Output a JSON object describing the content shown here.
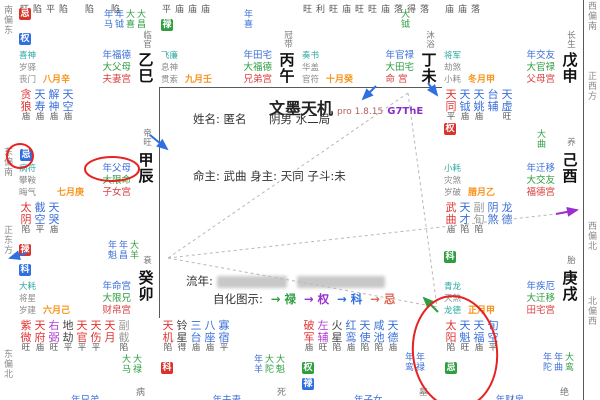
{
  "app": {
    "title": "文墨天机",
    "version": "pro 1.8.15",
    "build": "G7ThE"
  },
  "profile": {
    "name_label": "姓名:",
    "name": "匿名",
    "yinyang": "阴男",
    "bureau": "水二局",
    "ming_label": "命主:",
    "ming": "武曲",
    "shen_label": "身主:",
    "shen": "天同",
    "zidou_label": "子斗:",
    "zidou": "未",
    "liunian_label": "流年:",
    "zihua_label": "自化图示:",
    "zihua": [
      {
        "t": "→ 禄",
        "c": "#2f9e41"
      },
      {
        "t": "→ 权",
        "c": "#9b30d0"
      },
      {
        "t": "→ 科",
        "c": "#2f6fe0"
      },
      {
        "t": "→ 忌",
        "c": "#e2654f"
      }
    ]
  },
  "compass": {
    "left": [
      "南偏东",
      "东偏南",
      "正东方",
      "东偏北"
    ],
    "right": [
      "西偏南",
      "正西方",
      "西偏北",
      "北偏西"
    ]
  },
  "colors": {
    "main_star": "#e03434",
    "aux_star": "#3a6fd8",
    "purple_star": "#b040d0",
    "dark_star": "#444444",
    "gray_star": "#999999",
    "year_label": "#3a6fd8",
    "decade_label": "#2f9e41",
    "palace_label": "#d94040",
    "month": "#f7941d",
    "highlight": "#e62222"
  },
  "palaces": [
    {
      "id": "si",
      "branch": "乙巳",
      "stage": "临官",
      "month": "八月辛",
      "ratings_top": "旺陷平陷　陷　陷",
      "stars": [],
      "badges": [
        {
          "t": "忌",
          "bg": "#d9342b"
        },
        {
          "t": "权",
          "bg": "#2f6fe0"
        }
      ],
      "flow": [
        {
          "t": "年马",
          "c": "#3a6fd8"
        },
        {
          "t": "年钺",
          "c": "#3a6fd8"
        },
        {
          "t": "大喜",
          "c": "#2f9e41"
        },
        {
          "t": "大昌",
          "c": "#2f9e41"
        }
      ],
      "smalls": [
        {
          "t": "喜神",
          "c": "#2aa8a0"
        },
        {
          "t": "岁驿",
          "c": "#8a8a8a"
        },
        {
          "t": "丧门",
          "c": "#8a8a8a"
        }
      ],
      "labels": [
        {
          "t": "年福德",
          "c": "#3a6fd8"
        },
        {
          "t": "大父母",
          "c": "#2f9e41"
        },
        {
          "t": "夫妻宫",
          "c": "#d94040"
        }
      ]
    },
    {
      "id": "wu",
      "branch": "丙午",
      "stage": "冠带",
      "month": "九月壬",
      "ratings_top": "平庙庙庙",
      "stars": [],
      "badges": [
        {
          "t": "禄",
          "bg": "#2f9e41"
        }
      ],
      "flow": [
        {
          "t": "年喜",
          "c": "#3a6fd8"
        }
      ],
      "smalls": [
        {
          "t": "飞廉",
          "c": "#2aa8a0"
        },
        {
          "t": "息神",
          "c": "#8a8a8a"
        },
        {
          "t": "贯索",
          "c": "#8a8a8a"
        }
      ],
      "labels": [
        {
          "t": "年田宅",
          "c": "#3a6fd8"
        },
        {
          "t": "大福德",
          "c": "#2f9e41"
        },
        {
          "t": "兄弟宫",
          "c": "#d94040"
        }
      ]
    },
    {
      "id": "wei",
      "branch": "丁未",
      "stage": "沐浴",
      "month": "十月癸",
      "ratings_top": "旺利旺庙旺旺庙落得落",
      "stars": [],
      "badges": [],
      "flow": [
        {
          "t": "大钺",
          "c": "#2f9e41"
        }
      ],
      "smalls": [
        {
          "t": "奏书",
          "c": "#2aa8a0"
        },
        {
          "t": "华盖",
          "c": "#8a8a8a"
        },
        {
          "t": "官符",
          "c": "#8a8a8a"
        }
      ],
      "labels": [
        {
          "t": "年官禄",
          "c": "#3a6fd8"
        },
        {
          "t": "大田宅",
          "c": "#2f9e41"
        },
        {
          "t": "命 宫",
          "c": "#d94040"
        }
      ]
    },
    {
      "id": "shen",
      "branch": "戊申",
      "stage": "长生",
      "month": "冬月甲",
      "ratings_top": "庙庙落",
      "stars": [],
      "badges": [],
      "flow": [],
      "smalls": [
        {
          "t": "将军",
          "c": "#2aa8a0"
        },
        {
          "t": "劫煞",
          "c": "#8a8a8a"
        },
        {
          "t": "小耗",
          "c": "#8a8a8a"
        }
      ],
      "labels": [
        {
          "t": "年交友",
          "c": "#3a6fd8"
        },
        {
          "t": "大官禄",
          "c": "#2f9e41"
        },
        {
          "t": "父母宫",
          "c": "#d94040"
        }
      ]
    },
    {
      "id": "chen",
      "branch": "甲辰",
      "stage": "帝旺",
      "month": "七月庚",
      "ratings_top": "",
      "stars": [
        {
          "n": "贪狼",
          "c": "#e03434",
          "r": "庙"
        },
        {
          "n": "天寿",
          "c": "#3a6fd8",
          "r": "庙"
        },
        {
          "n": "解神",
          "c": "#3a6fd8",
          "r": "庙"
        },
        {
          "n": "天空",
          "c": "#3a6fd8",
          "r": "庙"
        }
      ],
      "badges": [
        {
          "t": "忌",
          "bg": "#2f6fe0"
        }
      ],
      "flow": [],
      "smalls": [
        {
          "t": "病符",
          "c": "#2aa8a0"
        },
        {
          "t": "攀鞍",
          "c": "#8a8a8a"
        },
        {
          "t": "晦气",
          "c": "#8a8a8a"
        }
      ],
      "labels": [
        {
          "t": "年父母",
          "c": "#3a6fd8"
        },
        {
          "t": "大限命",
          "c": "#2f9e41"
        },
        {
          "t": "子女宫",
          "c": "#d94040"
        }
      ]
    },
    {
      "id": "you",
      "branch": "己酉",
      "stage": "养",
      "month": "腊月乙",
      "ratings_top": "",
      "stars": [
        {
          "n": "天同",
          "c": "#e03434",
          "r": "平"
        },
        {
          "n": "天钺",
          "c": "#3a6fd8",
          "r": "庙"
        },
        {
          "n": "天姚",
          "c": "#3a6fd8",
          "r": "庙"
        },
        {
          "n": "台辅",
          "c": "#3a6fd8",
          "r": ""
        },
        {
          "n": "天虚",
          "c": "#3a6fd8",
          "r": "旺"
        }
      ],
      "badges": [
        {
          "t": "权",
          "bg": "#d9342b"
        }
      ],
      "flow": [
        {
          "t": "大曲",
          "c": "#2f9e41"
        }
      ],
      "smalls": [
        {
          "t": "小耗",
          "c": "#2aa8a0"
        },
        {
          "t": "灾煞",
          "c": "#8a8a8a"
        },
        {
          "t": "岁破",
          "c": "#8a8a8a"
        }
      ],
      "labels": [
        {
          "t": "年迁移",
          "c": "#3a6fd8"
        },
        {
          "t": "大交友",
          "c": "#2f9e41"
        },
        {
          "t": "福德宫",
          "c": "#d94040"
        }
      ]
    },
    {
      "id": "mao",
      "branch": "癸卯",
      "stage": "衰",
      "month": "六月己",
      "ratings_top": "",
      "stars": [
        {
          "n": "太阴",
          "c": "#e03434",
          "r": "陷"
        },
        {
          "n": "截空",
          "c": "#3a6fd8",
          "r": "平"
        },
        {
          "n": "天哭",
          "c": "#3a6fd8",
          "r": "庙"
        }
      ],
      "badges": [
        {
          "t": "禄",
          "bg": "#d9342b"
        },
        {
          "t": "科",
          "bg": "#2f6fe0"
        }
      ],
      "flow": [
        {
          "t": "年魁",
          "c": "#3a6fd8"
        },
        {
          "t": "年昌",
          "c": "#3a6fd8"
        },
        {
          "t": "大羊",
          "c": "#2f9e41"
        }
      ],
      "smalls": [
        {
          "t": "大耗",
          "c": "#2aa8a0"
        },
        {
          "t": "将星",
          "c": "#8a8a8a"
        },
        {
          "t": "岁建",
          "c": "#8a8a8a"
        }
      ],
      "labels": [
        {
          "t": "年命宫",
          "c": "#3a6fd8"
        },
        {
          "t": "大限兄",
          "c": "#2f9e41"
        },
        {
          "t": "财帛宫",
          "c": "#d94040"
        }
      ]
    },
    {
      "id": "xu",
      "branch": "庚戌",
      "stage": "胎",
      "month": "正月甲",
      "ratings_top": "",
      "stars": [
        {
          "n": "武曲",
          "c": "#e03434",
          "r": "庙"
        },
        {
          "n": "天才",
          "c": "#3a6fd8",
          "r": "陷"
        },
        {
          "n": "副旬",
          "c": "#999999",
          "r": "陷"
        },
        {
          "n": "阴煞",
          "c": "#3a6fd8",
          "r": ""
        },
        {
          "n": "龙德",
          "c": "#3a6fd8",
          "r": ""
        }
      ],
      "badges": [
        {
          "t": "科",
          "bg": "#2f9e41"
        }
      ],
      "flow": [],
      "smalls": [
        {
          "t": "青龙",
          "c": "#2aa8a0"
        },
        {
          "t": "天煞",
          "c": "#8a8a8a"
        },
        {
          "t": "龙德",
          "c": "#2aa8a0"
        }
      ],
      "labels": [
        {
          "t": "年疾厄",
          "c": "#3a6fd8"
        },
        {
          "t": "大迁移",
          "c": "#2f9e41"
        },
        {
          "t": "田宅宫",
          "c": "#d94040"
        }
      ]
    },
    {
      "id": "yin",
      "branch": "",
      "stage": "病",
      "month": "",
      "ratings_top": "",
      "stars": [
        {
          "n": "紫微",
          "c": "#e03434",
          "r": "旺"
        },
        {
          "n": "天府",
          "c": "#e03434",
          "r": "庙"
        },
        {
          "n": "右弼",
          "c": "#b040d0",
          "r": "旺"
        },
        {
          "n": "地劫",
          "c": "#444444",
          "r": "平"
        },
        {
          "n": "天官",
          "c": "#e03434",
          "r": "平"
        },
        {
          "n": "天伤",
          "c": "#e03434",
          "r": "平"
        },
        {
          "n": "天月",
          "c": "#e03434",
          "r": ""
        },
        {
          "n": "副截",
          "c": "#999999",
          "r": "陷"
        }
      ],
      "badges": [],
      "flow": [
        {
          "t": "大马",
          "c": "#2f9e41"
        },
        {
          "t": "大禄",
          "c": "#2f9e41"
        }
      ],
      "smalls": [],
      "labels": [],
      "bottom_label": {
        "t": "年兄弟",
        "c": "#3a6fd8"
      }
    },
    {
      "id": "chou",
      "branch": "",
      "stage": "死",
      "month": "",
      "ratings_top": "",
      "stars": [
        {
          "n": "天机",
          "c": "#e03434",
          "r": "陷"
        },
        {
          "n": "铃星",
          "c": "#444444",
          "r": "得"
        },
        {
          "n": "三台",
          "c": "#3a6fd8",
          "r": "庙"
        },
        {
          "n": "八座",
          "c": "#3a6fd8",
          "r": "庙"
        },
        {
          "n": "寡宿",
          "c": "#3a6fd8",
          "r": "平"
        }
      ],
      "badges": [
        {
          "t": "科",
          "bg": "#d9342b"
        }
      ],
      "flow": [
        {
          "t": "年羊",
          "c": "#3a6fd8"
        },
        {
          "t": "大陀",
          "c": "#2f9e41"
        },
        {
          "t": "大魁",
          "c": "#2f9e41"
        }
      ],
      "smalls": [],
      "labels": [],
      "bottom_label": {
        "t": "年夫妻",
        "c": "#3a6fd8"
      }
    },
    {
      "id": "zi",
      "branch": "",
      "stage": "墓",
      "month": "",
      "ratings_top": "",
      "stars": [
        {
          "n": "破军",
          "c": "#e03434",
          "r": "庙"
        },
        {
          "n": "左辅",
          "c": "#b040d0",
          "r": "旺"
        },
        {
          "n": "火星",
          "c": "#444444",
          "r": "陷"
        },
        {
          "n": "红鸾",
          "c": "#3a6fd8",
          "r": "庙"
        },
        {
          "n": "天使",
          "c": "#3a6fd8",
          "r": "陷"
        },
        {
          "n": "咸池",
          "c": "#3a6fd8",
          "r": "陷"
        },
        {
          "n": "天德",
          "c": "#3a6fd8",
          "r": "庙"
        }
      ],
      "badges": [
        {
          "t": "权",
          "bg": "#2f9e41"
        },
        {
          "t": "禄",
          "bg": "#2f6fe0"
        }
      ],
      "flow": [
        {
          "t": "年鸾",
          "c": "#3a6fd8"
        },
        {
          "t": "年禄",
          "c": "#3a6fd8"
        }
      ],
      "smalls": [],
      "labels": [],
      "bottom_label": {
        "t": "年子女",
        "c": "#3a6fd8"
      }
    },
    {
      "id": "hai",
      "branch": "",
      "stage": "绝",
      "month": "",
      "ratings_top": "",
      "stars": [
        {
          "n": "太阳",
          "c": "#e03434",
          "r": "陷"
        },
        {
          "n": "天魁",
          "c": "#3a6fd8",
          "r": "旺"
        },
        {
          "n": "天福",
          "c": "#3a6fd8",
          "r": "庙"
        },
        {
          "n": "旬空",
          "c": "#3a6fd8",
          "r": "平"
        }
      ],
      "badges": [
        {
          "t": "忌",
          "bg": "#2f9e41"
        }
      ],
      "flow": [
        {
          "t": "年陀",
          "c": "#3a6fd8"
        },
        {
          "t": "年曲",
          "c": "#3a6fd8"
        },
        {
          "t": "大鸾",
          "c": "#2f9e41"
        }
      ],
      "smalls": [],
      "labels": [],
      "bottom_label": {
        "t": "年财帛",
        "c": "#3a6fd8"
      }
    }
  ]
}
